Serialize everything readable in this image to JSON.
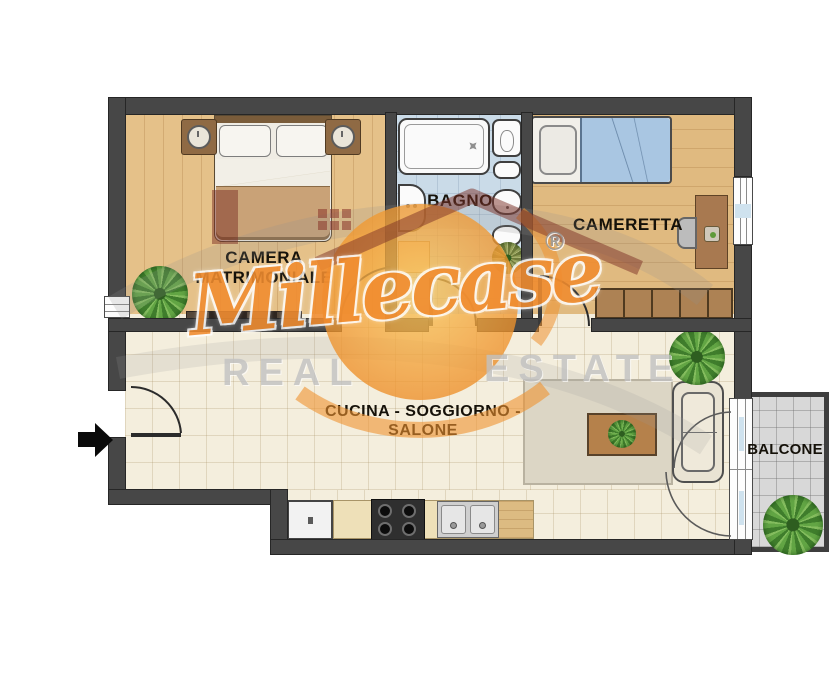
{
  "plan_title": "Apartment floor plan",
  "rooms": {
    "camera_matrimoniale": {
      "label_line1": "CAMERA",
      "label_line2": "MATRIMONIALE"
    },
    "bagno": {
      "label": "BAGNO"
    },
    "cameretta": {
      "label": "CAMERETTA"
    },
    "living": {
      "label": "CUCINA - SOGGIORNO - SALONE"
    },
    "balcone": {
      "label": "BALCONE"
    }
  },
  "watermark": {
    "brand": "Millecase",
    "registered": "®",
    "word1": "REAL",
    "word2": "ESTATE"
  },
  "colors": {
    "wall": "#474747",
    "wood_floor": "#e5c189",
    "bathroom_floor": "#cadbe8",
    "living_floor": "#f4eedd",
    "balcony_floor": "#d8d8d8",
    "blanket_blue": "#a9c6e2",
    "brand_orange": "#f18c2f",
    "logo_red": "#7b3026",
    "watermark_gray": "#c2c2c2"
  }
}
